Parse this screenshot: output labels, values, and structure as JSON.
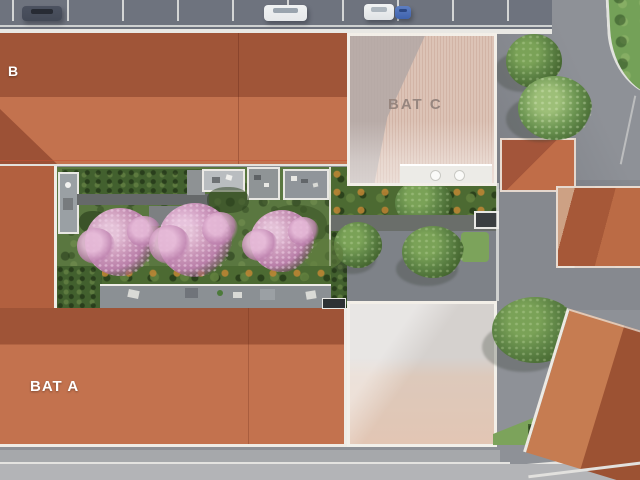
{
  "scene": {
    "kind": "aerial residence site plan rendering"
  },
  "buildings": {
    "b": {
      "label": "B"
    },
    "a": {
      "label": "BAT A"
    },
    "c": {
      "label": "BAT C"
    }
  },
  "inventory": {
    "cars_parked": 4,
    "blossom_trees": 3
  },
  "colors": {
    "roof_dark": "#a05538",
    "roof_main": "#b2603f",
    "roof_light": "#c3724e",
    "ghost_roof": "#dcc3b6",
    "ghost_label": "#97867f",
    "asphalt": "#8e9197",
    "parking_asphalt": "#6e737e",
    "road_light": "#b3b4b7",
    "sidewalk": "#e9e8e4",
    "grass_courtyard": "#5a7740",
    "hedge_dark": "#42602e",
    "lawn_light": "#7ca35b",
    "tree_green": "#5d8345",
    "blossom_pink": "#b97fa9",
    "terrace_gray": "#90959a",
    "car_dark": "#434956",
    "car_white": "#e6e8ea",
    "car_blue": "#3f63ae"
  }
}
